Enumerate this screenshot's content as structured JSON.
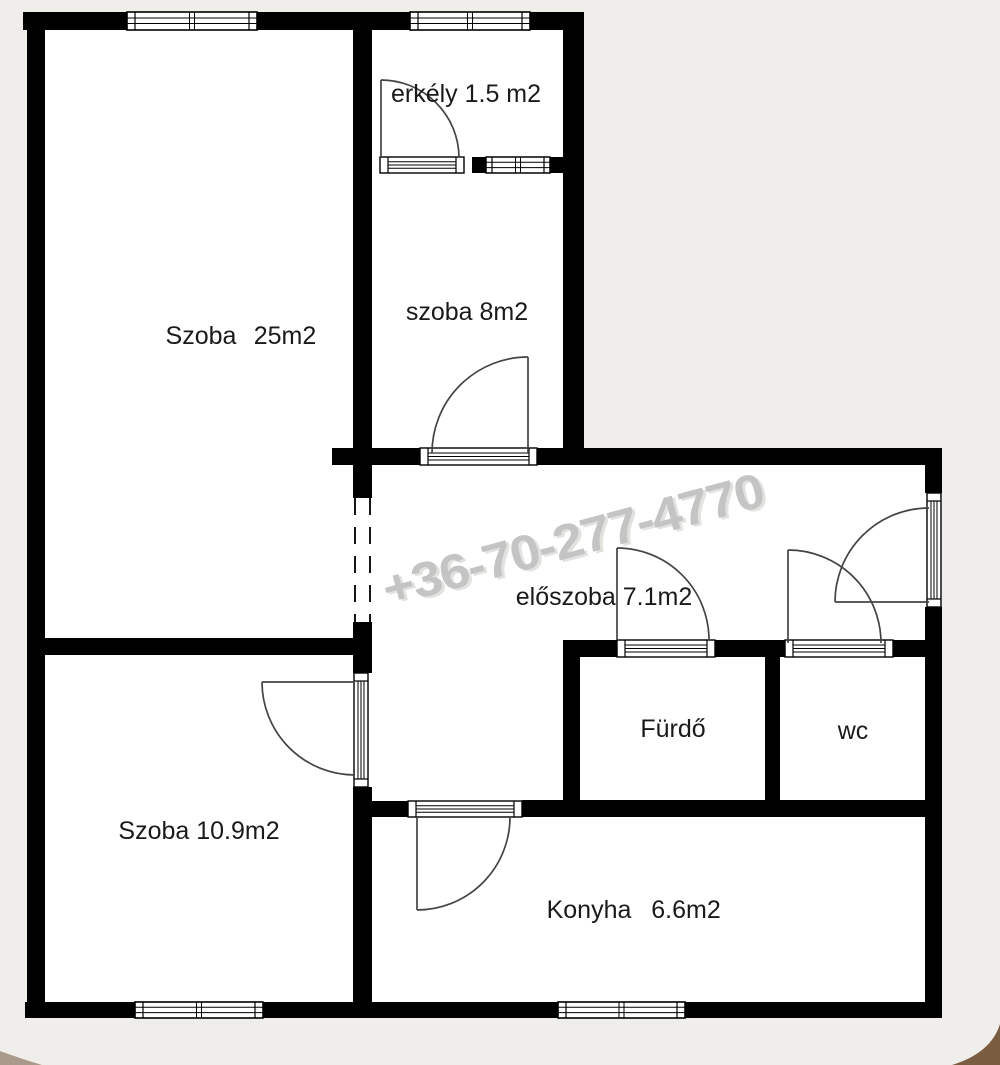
{
  "plan": {
    "watermark": {
      "text": "+36-70-277-4770",
      "color": "#c4c4c4"
    },
    "colors": {
      "background": "#f0eeea",
      "floor": "#ffffff",
      "wall": "#000000",
      "door_line": "#444444",
      "label": "#1a1a1a"
    },
    "rooms": {
      "erkely": {
        "label": "erkély 1.5 m2"
      },
      "szoba8": {
        "label": "szoba 8m2"
      },
      "szoba25": {
        "name": "Szoba",
        "area": "25m2"
      },
      "eloszoba": {
        "label": "előszoba 7.1m2"
      },
      "furdo": {
        "label": "Fürdő"
      },
      "wc": {
        "label": "wc"
      },
      "szoba109": {
        "label": "Szoba 10.9m2"
      },
      "konyha": {
        "name": "Konyha",
        "area": "6.6m2"
      }
    }
  }
}
